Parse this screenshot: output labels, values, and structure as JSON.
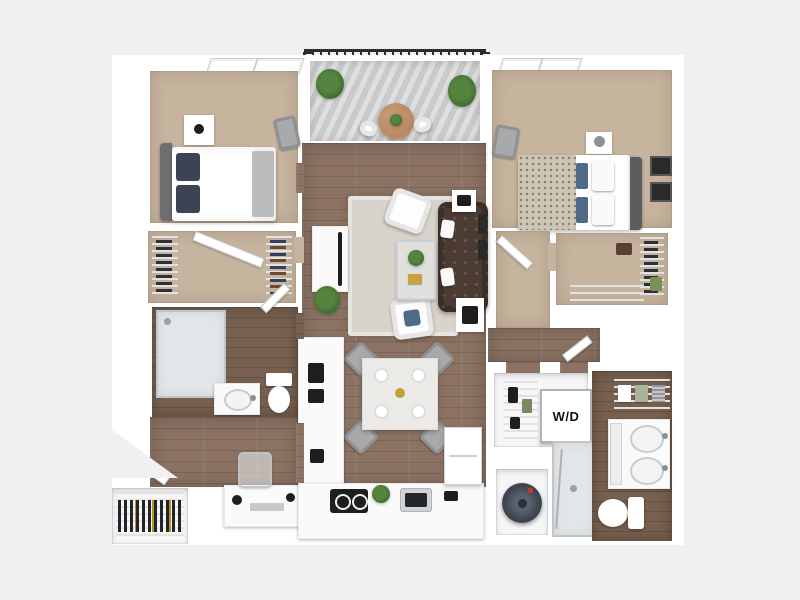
{
  "scene": {
    "description": "3D rendered top-down floor plan of a two-bedroom two-bath apartment with balcony",
    "background": "#f0f0f1"
  },
  "labels": {
    "washer_dryer": "W/D"
  },
  "palette": {
    "background": "#f0f0f1",
    "wall": "#ffffff",
    "wood": "#8b7263",
    "wood_dark": "#77604f",
    "carpet": "#c7b49e",
    "rug": "#d8d4cc",
    "glass": "#e3e6e8",
    "deck": "#c9cacb",
    "railing": "#2d2d2d",
    "sofa": "#4b3b33",
    "pillow_blue": "#4e6a86",
    "plant": "#55843f",
    "plant_dark": "#3f6b31",
    "counter": "#fafafa",
    "appliance_black": "#1e1e1e",
    "chair_gray": "#a7a9ab",
    "knit": "#cec5b4",
    "heater": "#3d4450",
    "table_wood": "#b2805d",
    "marble": "#eceae6",
    "frame_dark": "#2a2a2a",
    "headboard_gray": "#6f6f72",
    "pillow_navy": "#3c4352"
  }
}
